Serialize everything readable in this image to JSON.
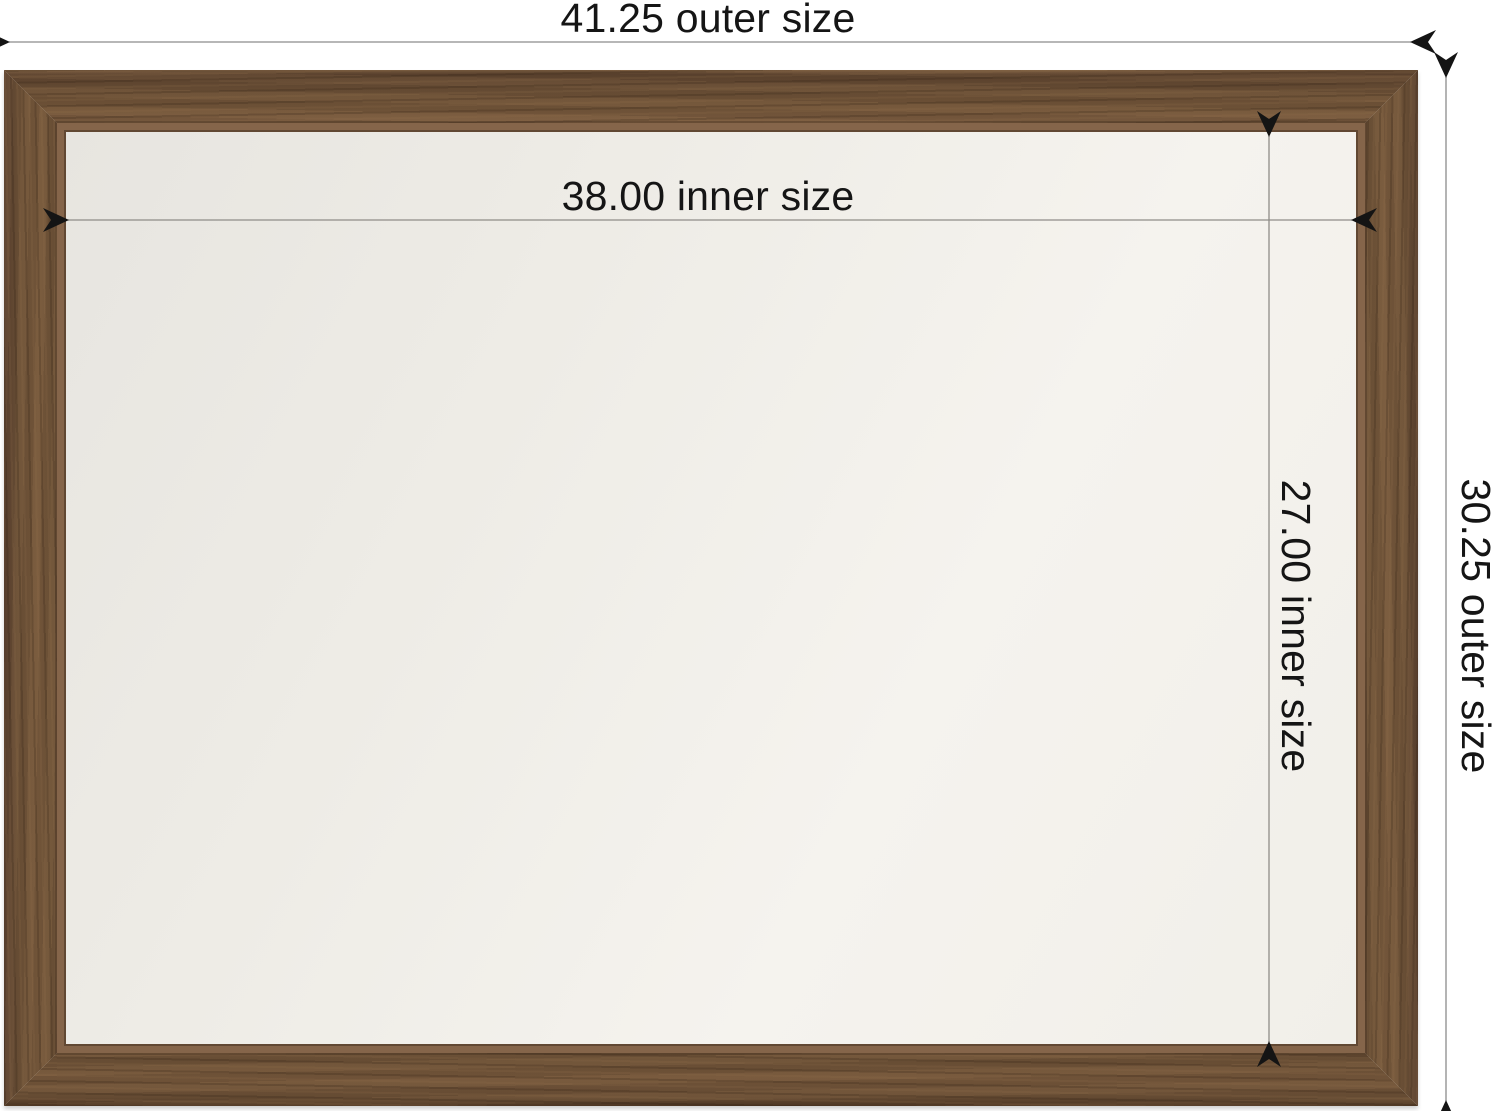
{
  "diagram": {
    "type": "product-dimension-diagram",
    "subject": "wood framed mirror",
    "dimensions": {
      "outer_width": {
        "value": 41.25,
        "label": "41.25 outer size"
      },
      "outer_height": {
        "value": 30.25,
        "label": "30.25 outer size"
      },
      "inner_width": {
        "value": 38.0,
        "label": "38.00 inner size"
      },
      "inner_height": {
        "value": 27.0,
        "label": "27.00 inner size"
      }
    }
  },
  "colors": {
    "background": "#ffffff",
    "wood_base": "#6e5339",
    "wood_dark": "#543b27",
    "wood_light": "#8a6a4a",
    "wood_lip": "#85654a",
    "mirror": "#f2f0ea",
    "line": "#8c8c8c",
    "arrow": "#141414",
    "text": "#151515"
  }
}
